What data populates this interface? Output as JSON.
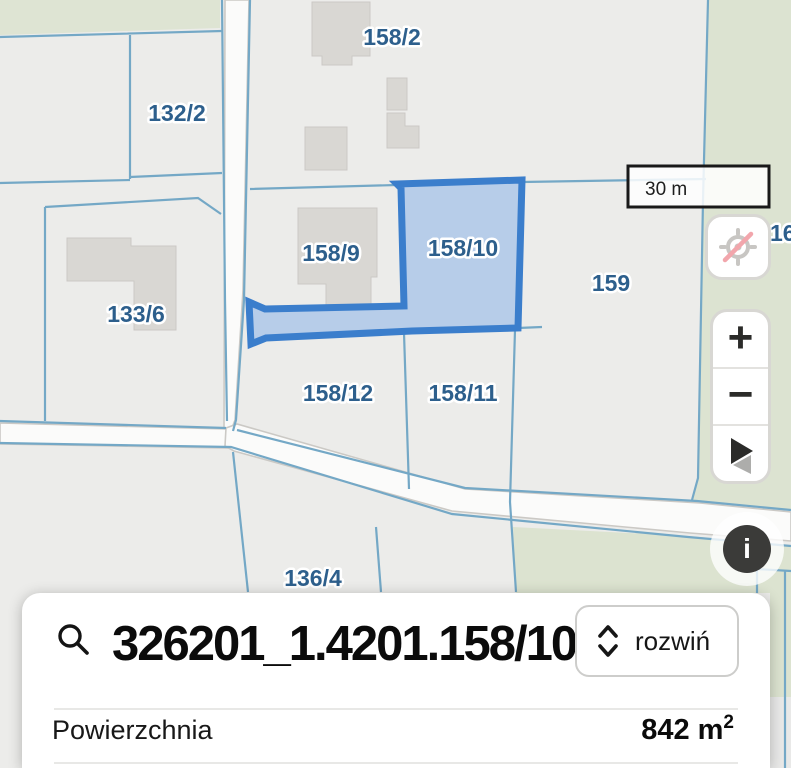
{
  "map": {
    "parcel_labels": [
      {
        "id": "158/2",
        "label": "158/2"
      },
      {
        "id": "132/2",
        "label": "132/2"
      },
      {
        "id": "158/9",
        "label": "158/9"
      },
      {
        "id": "158/10",
        "label": "158/10"
      },
      {
        "id": "159",
        "label": "159"
      },
      {
        "id": "133/6",
        "label": "133/6"
      },
      {
        "id": "158/12",
        "label": "158/12"
      },
      {
        "id": "158/11",
        "label": "158/11"
      },
      {
        "id": "136/4",
        "label": "136/4"
      },
      {
        "id": "16",
        "label": "16"
      }
    ],
    "scale_bar_label": "30 m",
    "selected_parcel": "158/10",
    "colors": {
      "selected_fill": "#B7CDE9",
      "selected_stroke": "#3B7ECC",
      "boundary_line": "#74A8C6",
      "label_text": "#2D5F8C",
      "vegetation": "#DEE4D3",
      "road_fill": "#FBFBFA",
      "background": "#ECECEA"
    }
  },
  "controls": {
    "zoom_in_glyph": "+",
    "zoom_out_glyph": "−",
    "info_glyph": "i"
  },
  "panel": {
    "search_value": "326201_1.4201.158/10",
    "expand_label": "rozwiń",
    "area_label": "Powierzchnia",
    "area_value": "842 m",
    "area_superscript": "2"
  }
}
